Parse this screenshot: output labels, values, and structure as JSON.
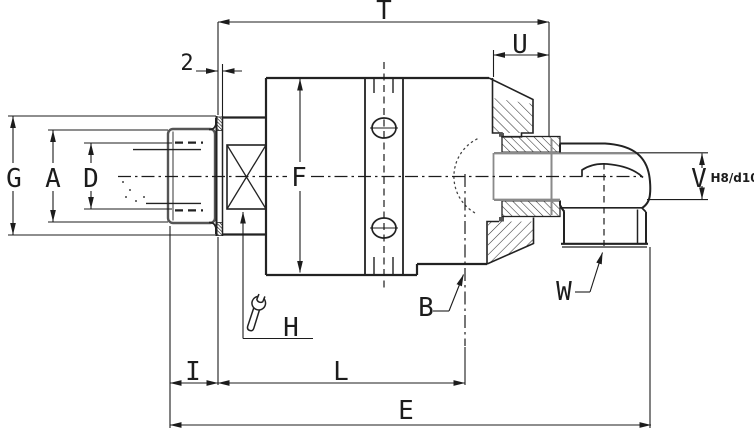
{
  "drawing": {
    "colors": {
      "background": "#ffffff",
      "line": "#1c1c1c",
      "seal_gray": "#8a8a8a"
    },
    "dimension_labels": {
      "t": "T",
      "u": "U",
      "flange_width": "2",
      "g": "G",
      "a": "A",
      "d": "D",
      "f": "F",
      "i": "I",
      "l": "L",
      "e": "E",
      "v": "V",
      "fit": "H8/d10"
    },
    "callouts": {
      "b": "B",
      "w": "W",
      "h": "H"
    },
    "icons": {
      "wrench": "wrench-icon"
    }
  }
}
